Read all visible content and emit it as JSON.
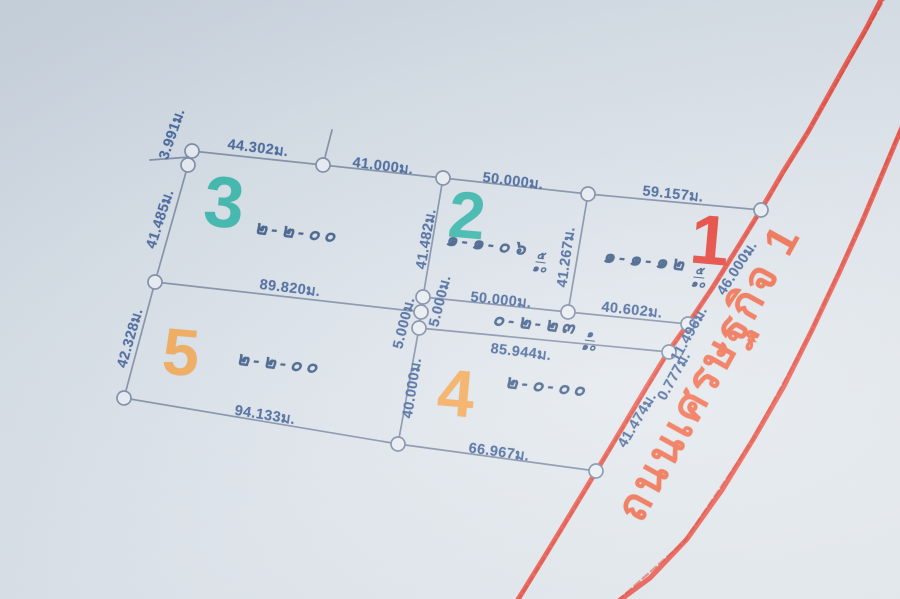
{
  "document": {
    "kind": "land-survey-plot-plan",
    "road_name": "ถนนเศรษฐกิจ 1"
  },
  "colors": {
    "paper_top": "#ccd5de",
    "paper_bottom": "#e5eaee",
    "boundary_line": "#748393",
    "dimension_text": "#3a5c95",
    "area_text": "#31517f",
    "plot_teal": "#2db3a6",
    "plot_orange": "#f4a44a",
    "plot_red": "#e63529",
    "road_line": "#ee4334",
    "road_text": "#ef6340"
  },
  "plots": {
    "p1": {
      "number": "1",
      "area": "๑-๑-๑๒",
      "frac_num": "๕",
      "frac_den": "๑๐"
    },
    "p2": {
      "number": "2",
      "area": "๑-๑-๐๖",
      "frac_num": "๕",
      "frac_den": "๑๐"
    },
    "p3": {
      "number": "3",
      "area": "๒-๒-๐๐"
    },
    "p4": {
      "number": "4",
      "area": "๒-๐-๐๐"
    },
    "p5": {
      "number": "5",
      "area": "๒-๒-๐๐"
    },
    "strip": {
      "area": "๐-๒-๒๓",
      "frac_num": "๑",
      "frac_den": "๑๐"
    }
  },
  "measurements": {
    "m3991": "3.991ม.",
    "m44302": "44.302ม.",
    "m41000": "41.000ม.",
    "m50000_top": "50.000ม.",
    "m59157": "59.157ม.",
    "m41485": "41.485ม.",
    "m41482": "41.482ม.",
    "m41267": "41.267ม.",
    "m46000": "46.000ม.",
    "m89820": "89.820ม.",
    "m5000_left": "5.000ม.",
    "m5000_right": "5.000ม.",
    "m50000_mid": "50.000ม.",
    "m40602": "40.602ม.",
    "m85944": "85.944ม.",
    "m11496": "11.496ม.",
    "m0777": "0.777ม.",
    "m42328": "42.328ม.",
    "m40000": "40.000ม.",
    "m41474": "41.474ม.",
    "m94133": "94.133ม.",
    "m66967": "66.967ม."
  }
}
